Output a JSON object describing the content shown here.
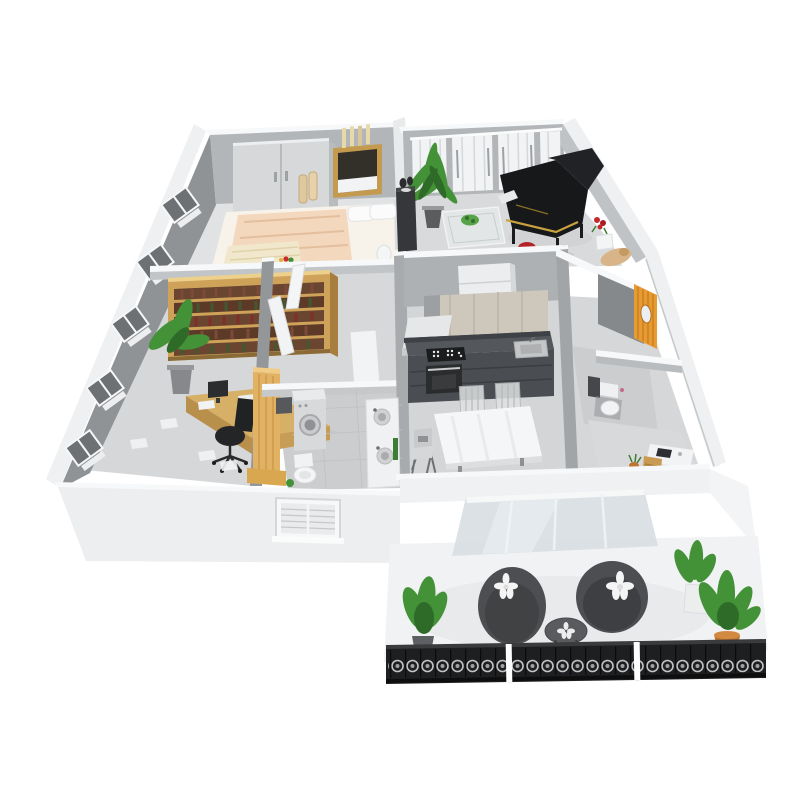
{
  "meta": {
    "title": "3D isometric cutaway floor plan render of a furnished apartment",
    "style": "photoreal 3D dollhouse view on white background",
    "background": "#ffffff"
  },
  "colors": {
    "wallFace": "#b3b6b9",
    "wallFaceDark": "#909396",
    "wallTop": "#f7f8f9",
    "wallOuter": "#eef0f1",
    "floor": "#d8dadc",
    "floorDark": "#cbcdcf",
    "wood": "#cfa25a",
    "woodDark": "#a87e3e",
    "bedPeach": "#f3d8bd",
    "bedCream": "#f0e7cd",
    "piano": "#17181a",
    "pianoGold": "#c9a23f",
    "stoolRed": "#b22226",
    "plant": "#449238",
    "plantDark": "#2f6b28",
    "terracotta": "#bf7430",
    "orange": "#e89a33",
    "counter": "#4a4d51",
    "cabinet": "#cdc8bb",
    "whiteFurn": "#f3f4f5",
    "railing": "#1e1f21",
    "glass": "#d6dde1",
    "chairDark": "#4c4e51"
  },
  "rooms": [
    {
      "id": "bedroom",
      "label": "Bedroom",
      "furniture": [
        "double-door wardrobe",
        "framed window art",
        "double bed with peach duvet",
        "white pillows",
        "decor vases",
        "laundry basket"
      ]
    },
    {
      "id": "living-room",
      "label": "Living room",
      "furniture": [
        "grand piano",
        "red piano stool",
        "curtained windows",
        "tall potted plant",
        "dark side cabinet with vases",
        "glass coffee table",
        "red flower decor"
      ]
    },
    {
      "id": "study",
      "label": "Study",
      "furniture": [
        "wooden bookshelf full of books",
        "corner desk with monitor",
        "black office chair",
        "potted plant",
        "wall windows",
        "scattered papers",
        "wood door panel"
      ]
    },
    {
      "id": "hallway",
      "label": "Hallway",
      "furniture": [
        "open white doors"
      ]
    },
    {
      "id": "bathroom",
      "label": "Bathroom",
      "furniture": [
        "washing machine",
        "toilet",
        "double-basin vanity",
        "green plant"
      ]
    },
    {
      "id": "kitchen",
      "label": "Kitchen",
      "furniture": [
        "refrigerator",
        "upper cabinets",
        "range hood",
        "dark cooktop counter",
        "oven",
        "sink",
        "white dining table",
        "two chairs",
        "high chair"
      ]
    },
    {
      "id": "entry",
      "label": "Entry",
      "furniture": [
        "orange woven screen cabinet"
      ]
    },
    {
      "id": "wc",
      "label": "WC",
      "furniture": [
        "toilet",
        "small dark cabinet"
      ]
    },
    {
      "id": "utility-room",
      "label": "Utility room",
      "furniture": [
        "white desk",
        "wooden step stool",
        "terracotta pot"
      ]
    },
    {
      "id": "balcony",
      "label": "Balcony",
      "furniture": [
        "two round wicker lounge chairs with flower cushions",
        "round side table",
        "potted plants",
        "ornate black railing",
        "leaning sliding glass door"
      ]
    }
  ]
}
